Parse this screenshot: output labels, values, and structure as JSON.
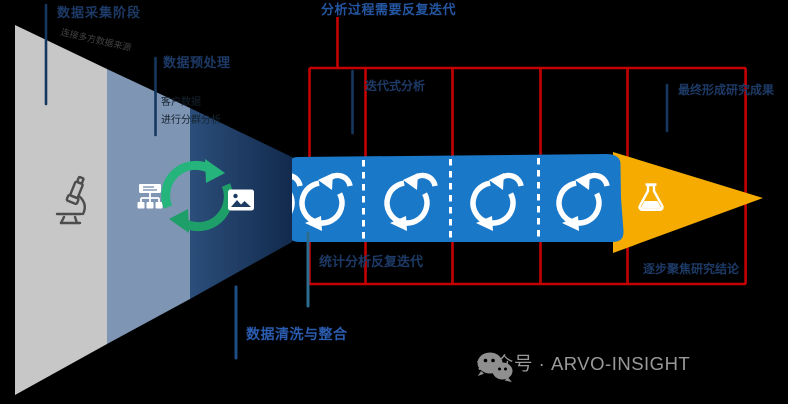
{
  "labels": {
    "top_left": {
      "title": "数据采集阶段",
      "note": "连接多方数据来源"
    },
    "preprocess": {
      "title": "数据预处理",
      "note_line1": "客户数据",
      "note_line2": "进行分群分析"
    },
    "cleaning": {
      "title": "数据清洗与整合"
    },
    "iteration_top": {
      "title": "分析过程需要反复迭代"
    },
    "iteration_col": {
      "title": "迭代式分析"
    },
    "stats_bottom": {
      "title": "统计分析反复迭代"
    },
    "result_right": {
      "title": "最终形成研究成果"
    },
    "focus_bottom_right": {
      "title": "逐步聚焦研究结论"
    }
  },
  "watermark": {
    "text": "公众号 · ARVO-INSIGHT"
  },
  "icons": {
    "funnel_stage1": "microscope-icon",
    "funnel_stage2": "org-chart-icon",
    "funnel_merge": "sync-icon",
    "funnel_stage3": "photo-icon",
    "band_step": "loop-arrow-icon",
    "output": "flask-icon",
    "watermark": "wechat-icon"
  },
  "colors": {
    "red_grid": "#c40000",
    "band_blue": "#1a78c9",
    "funnel_gray": "#c7c7c7",
    "funnel_steel": "#7e95b4",
    "arrow_gold": "#f5ab00",
    "marker_navy": "#16375f",
    "marker_teal": "#2a6d8e",
    "watermark_gray": "#999999",
    "sync_green": "#25b47b"
  }
}
